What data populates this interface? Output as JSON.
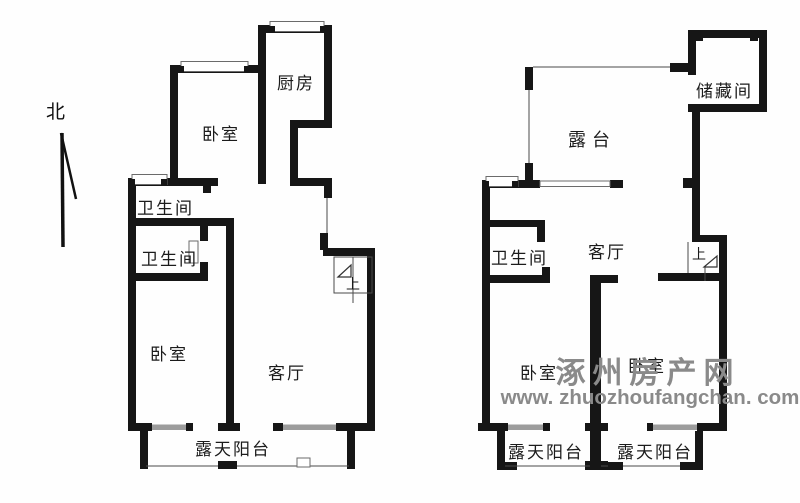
{
  "compass": {
    "north_label": "北"
  },
  "left_plan": {
    "rooms": {
      "bedroom_north": "卧室",
      "kitchen": "厨房",
      "bathroom_1": "卫生间",
      "bathroom_2": "卫生间",
      "bedroom_south": "卧室",
      "living_room": "客厅",
      "balcony": "露天阳台",
      "stairs_up": "上"
    }
  },
  "right_plan": {
    "rooms": {
      "terrace": "露台",
      "storage": "储藏间",
      "bathroom": "卫生间",
      "living_room": "客厅",
      "bedroom_left": "卧室",
      "bedroom_right": "卧室",
      "balcony_left": "露天阳台",
      "balcony_right": "露天阳台",
      "stairs_up": "上"
    }
  },
  "watermark": {
    "site_name": "涿州房产网",
    "url": "www. zhuozhoufangchan. com",
    "color": "#8a8a8a"
  },
  "colors": {
    "wall": "#161616",
    "window_frame": "#6b6b6b",
    "balcony_window_gray": "#9c9c9c",
    "background": "#fefefe"
  }
}
